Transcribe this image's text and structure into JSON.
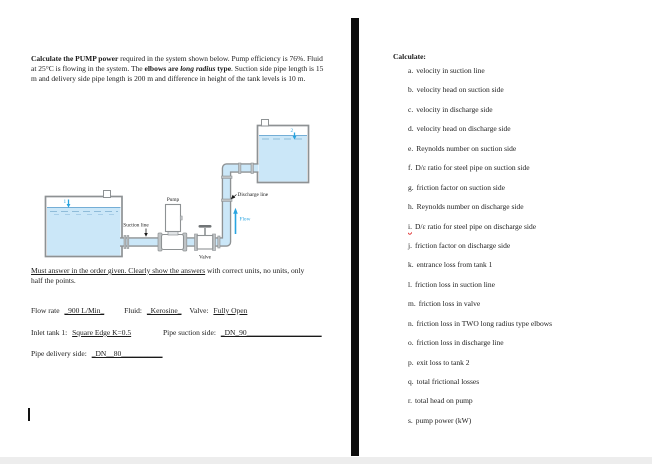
{
  "left_page": {
    "problem": {
      "bold_lead": "Calculate the PUMP power",
      "normal_1": " required in the system shown below. Pump efficiency is 76%. Fluid at 25°C is flowing in the system. The ",
      "bold_2": "elbows are ",
      "bold_italic": "long radius ",
      "bold_3": "type",
      "normal_2": ". Suction side pipe length is 15 m and delivery side pipe length is 200 m and difference in height of the tank levels is 10 m."
    },
    "diagram": {
      "tank1_marker": "1",
      "tank2_marker": "2",
      "pump_label": "Pump",
      "valve_label": "Valve",
      "suction_label": "Suction line",
      "discharge_label": "Discharge line",
      "flow_label": "Flow",
      "colors": {
        "water": "#cbe7f8",
        "outline": "#8e9294",
        "flange": "#bfc3c5",
        "accent_blue": "#29a4e0"
      }
    },
    "must_answer": {
      "underlined": "Must answer in the order given. Clearly show the answers",
      "rest": " with correct units, no units, only half the points."
    },
    "fills": {
      "flow_rate_label": "Flow rate",
      "flow_rate_value": "_900 L/Min_",
      "fluid_label": "Fluid:",
      "fluid_value": "_Kerosine_",
      "valve_label": "Valve:",
      "valve_value": "Fully Open",
      "inlet_label": "Inlet tank 1:",
      "inlet_value": "Square Edge K=0.5",
      "suction_side_label": "Pipe suction side:",
      "suction_side_value": "_DN_90____________________",
      "delivery_label": "Pipe delivery side:",
      "delivery_value": "_DN__80___________"
    }
  },
  "right_page": {
    "heading": "Calculate:",
    "items": [
      {
        "prefix": "a.",
        "text": "velocity in suction line"
      },
      {
        "prefix": "b.",
        "text": "velocity head on suction side"
      },
      {
        "prefix": "c.",
        "text": "velocity in discharge side"
      },
      {
        "prefix": "d.",
        "text": "velocity head on discharge side"
      },
      {
        "prefix": "e.",
        "text": "Reynolds number on suction side"
      },
      {
        "prefix": "f.",
        "text": "D/ε ratio for steel pipe on suction side"
      },
      {
        "prefix": "g.",
        "text": "friction factor on suction side"
      },
      {
        "prefix": "h.",
        "text": "Reynolds number on discharge side"
      },
      {
        "prefix": "i.",
        "text": "D/ε ratio for steel pipe on discharge side"
      },
      {
        "prefix": "j.",
        "text": "friction factor on discharge side"
      },
      {
        "prefix": "k.",
        "text": "entrance loss from tank 1"
      },
      {
        "prefix": "l.",
        "text": "friction loss in suction line"
      },
      {
        "prefix": "m.",
        "text": "friction loss in valve"
      },
      {
        "prefix": "n.",
        "text": "friction loss in TWO long radius type elbows"
      },
      {
        "prefix": "o.",
        "text": "friction loss in discharge line"
      },
      {
        "prefix": "p.",
        "text": "exit loss to tank 2"
      },
      {
        "prefix": "q.",
        "text": "total frictional losses"
      },
      {
        "prefix": "r.",
        "text": "total head on pump"
      },
      {
        "prefix": "s.",
        "text": "pump power (kW)"
      }
    ]
  }
}
